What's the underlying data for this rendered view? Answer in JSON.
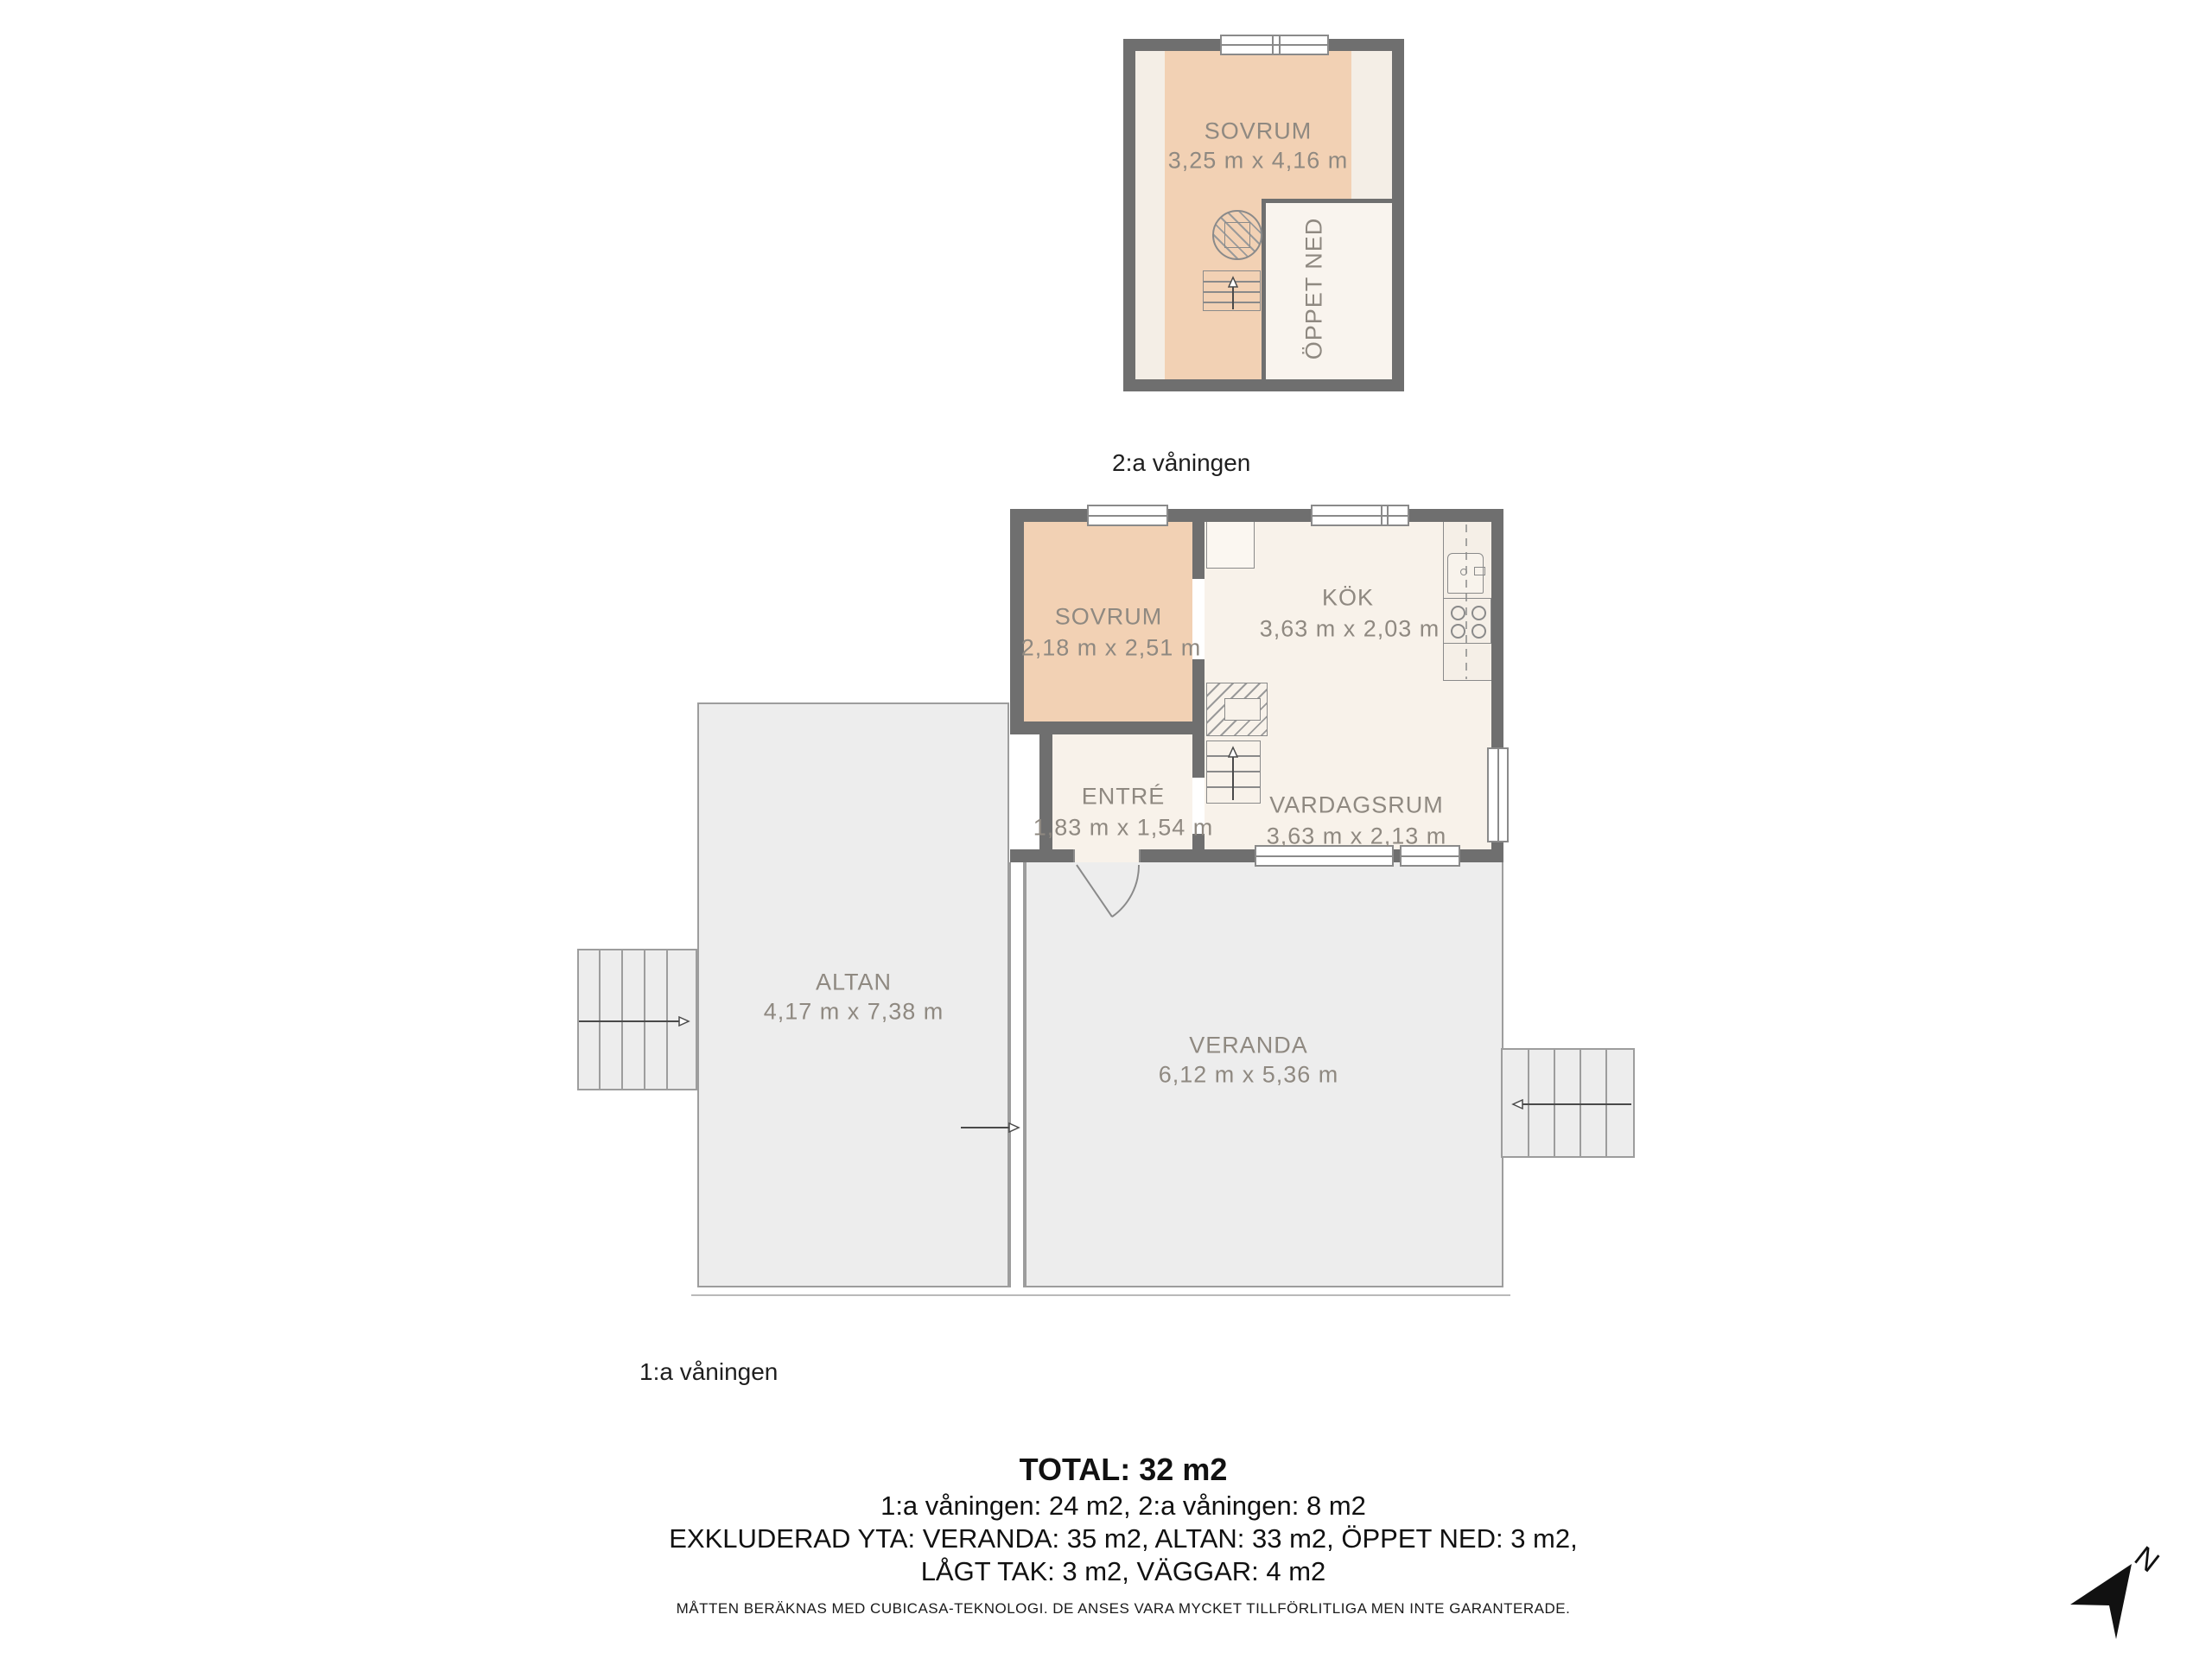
{
  "colors": {
    "wall": "#6f6f6f",
    "room_peach": "#f2d1b4",
    "room_cream": "#f8f2ea",
    "strip_cream": "#f4eee6",
    "open_below": "#f9f4ee",
    "outdoor_gray": "#ededed",
    "outdoor_border": "#9d9d9d",
    "fixture_line": "#8a8a8a",
    "room_label": "#8f8981",
    "text": "#1a1a1a"
  },
  "floors": {
    "second": {
      "label": "2:a våningen",
      "rooms": {
        "sovrum": {
          "name": "SOVRUM",
          "dims": "3,25 m x 4,16 m"
        },
        "oppet_ned": {
          "name": "ÖPPET NED"
        }
      }
    },
    "first": {
      "label": "1:a våningen",
      "rooms": {
        "sovrum": {
          "name": "SOVRUM",
          "dims": "2,18 m x 2,51 m"
        },
        "kok": {
          "name": "KÖK",
          "dims": "3,63 m x 2,03 m"
        },
        "entre": {
          "name": "ENTRÉ",
          "dims": "1,83 m x 1,54 m"
        },
        "vardagsrum": {
          "name": "VARDAGSRUM",
          "dims": "3,63 m x 2,13 m"
        },
        "altan": {
          "name": "ALTAN",
          "dims": "4,17 m x 7,38 m"
        },
        "veranda": {
          "name": "VERANDA",
          "dims": "6,12 m x 5,36 m"
        }
      }
    }
  },
  "summary": {
    "total": "TOTAL: 32 m2",
    "line2": "1:a våningen: 24 m2, 2:a våningen: 8 m2",
    "line3": "EXKLUDERAD YTA: VERANDA: 35 m2, ALTAN: 33 m2, ÖPPET NED: 3 m2,",
    "line4": "LÅGT TAK: 3 m2, VÄGGAR: 4 m2"
  },
  "disclaimer": "MÅTTEN BERÄKNAS MED CUBICASA-TEKNOLOGI. DE ANSES VARA MYCKET TILLFÖRLITLIGA MEN INTE GARANTERADE.",
  "compass": {
    "label": "N"
  }
}
